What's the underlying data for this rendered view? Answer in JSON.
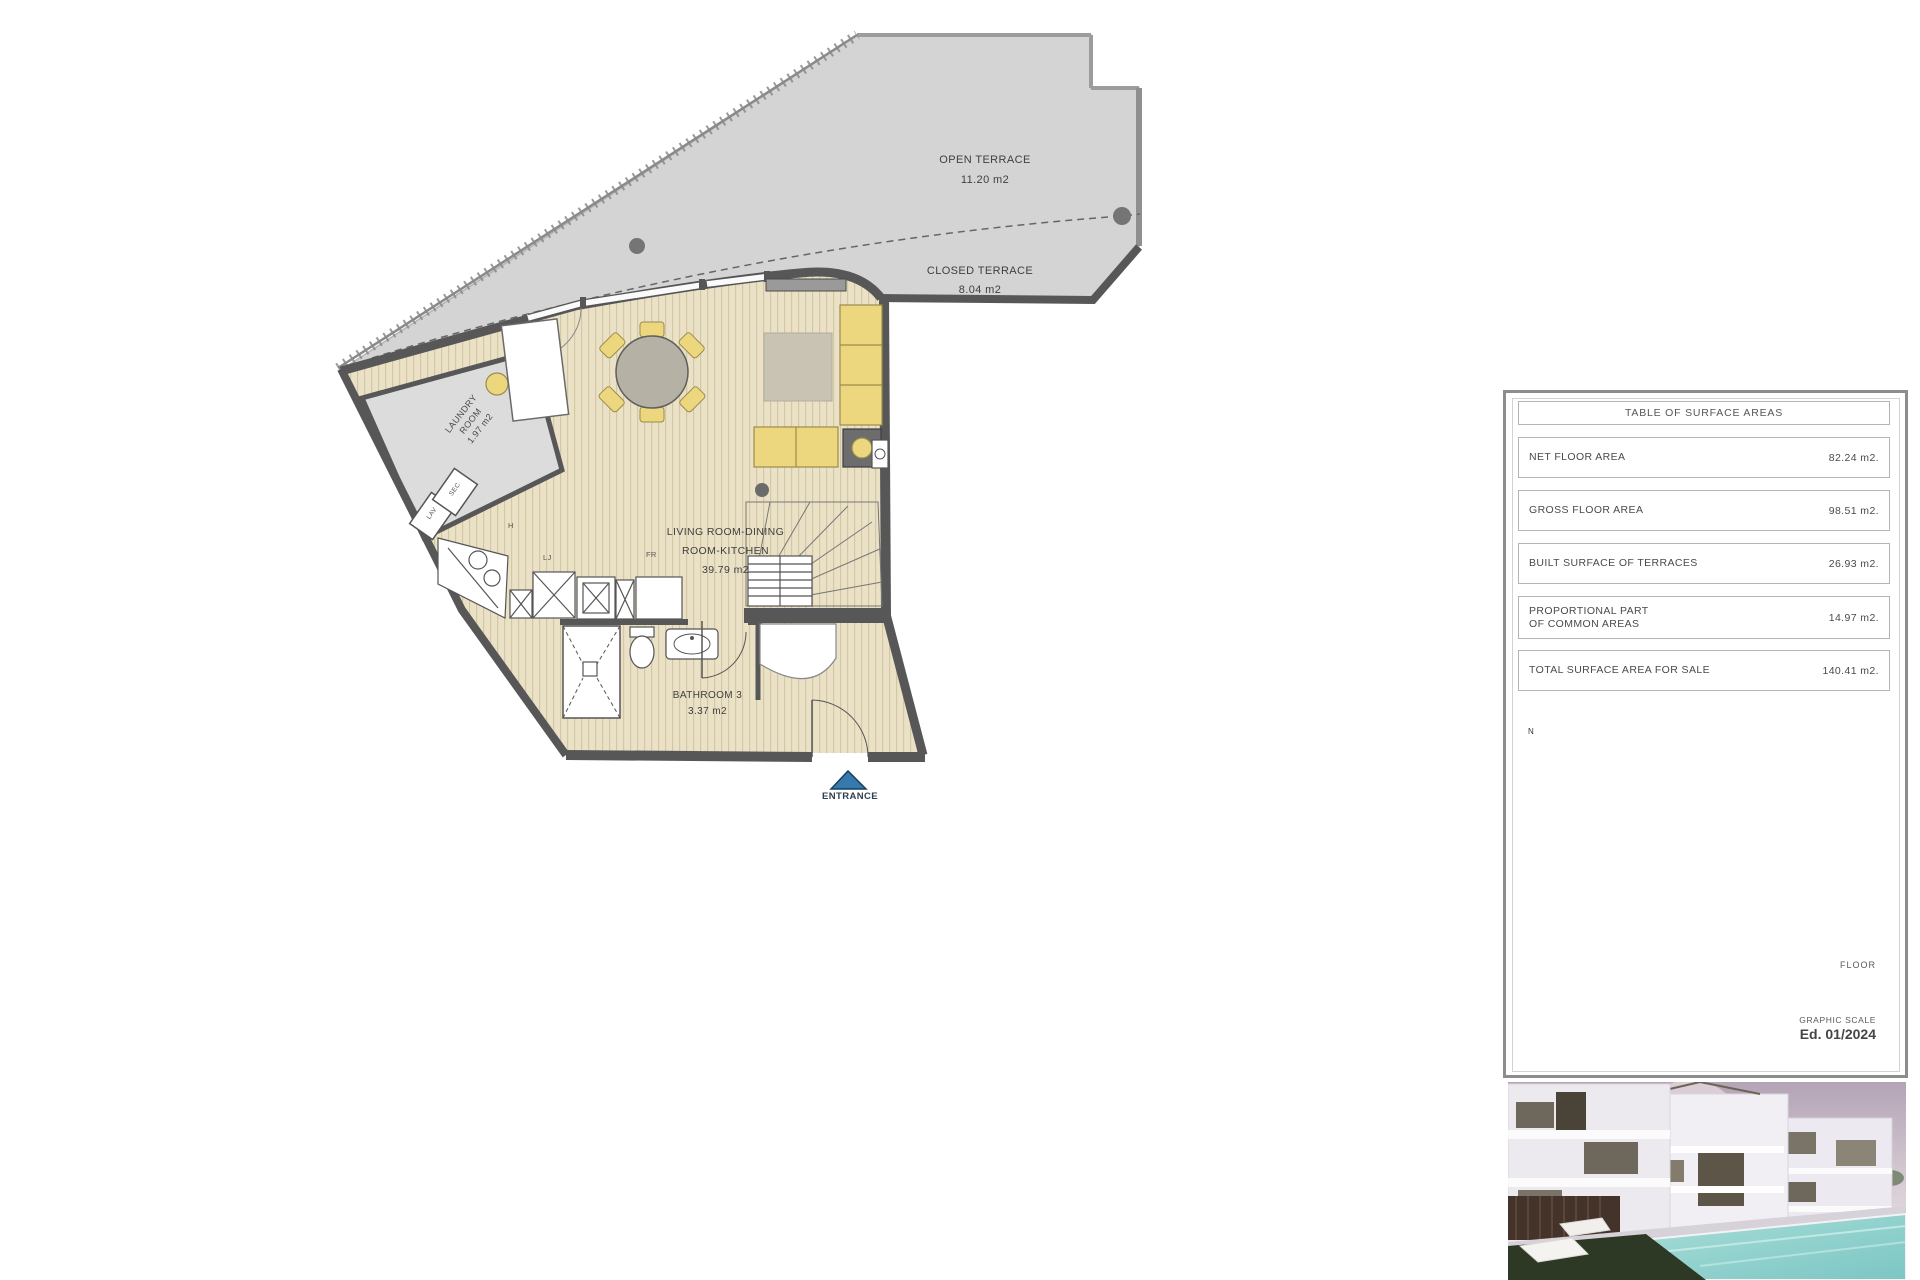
{
  "floor_plan": {
    "rooms": {
      "open_terrace": {
        "name": "OPEN TERRACE",
        "area": "11.20 m2"
      },
      "closed_terrace": {
        "name": "CLOSED TERRACE",
        "area": "8.04 m2"
      },
      "living": {
        "line1": "LIVING ROOM-DINING",
        "line2": "ROOM-KITCHEN",
        "area": "39.79 m2"
      },
      "bathroom": {
        "name": "BATHROOM 3",
        "area": "3.37 m2"
      },
      "laundry": {
        "line1": "LAUNDRY",
        "line2": "ROOM",
        "area": "1.97 m2"
      }
    },
    "labels": {
      "entrance": "ENTRANCE",
      "washer": "LAV",
      "dryer": "SEC",
      "hood": "H",
      "dishwasher": "LJ",
      "fridge": "FR",
      "north": "N"
    }
  },
  "surface_table": {
    "title": "TABLE OF SURFACE AREAS",
    "rows": [
      {
        "label": "NET FLOOR AREA",
        "label2": "",
        "value": "82.24 m2."
      },
      {
        "label": "GROSS FLOOR AREA",
        "label2": "",
        "value": "98.51 m2."
      },
      {
        "label": "BUILT SURFACE OF TERRACES",
        "label2": "",
        "value": "26.93 m2."
      },
      {
        "label": "PROPORTIONAL PART",
        "label2": "OF COMMON AREAS",
        "value": "14.97 m2."
      },
      {
        "label": "TOTAL SURFACE AREA FOR SALE",
        "label2": "",
        "value": "140.41 m2."
      }
    ]
  },
  "site": {
    "floor_label": "FLOOR",
    "graphic_scale_label": "GRAPHIC SCALE",
    "edition": "Ed. 01/2024",
    "scale_ticks": [
      "0",
      "1",
      "2",
      "3",
      "4"
    ]
  },
  "colors": {
    "highlight_red": "#d63058",
    "entrance_blue": "#3579ad",
    "terrace_gray": "#d4d4d4",
    "wall_gray": "#575757",
    "floor_tan": "#eae1c6",
    "furniture_yellow": "#ecd77e"
  }
}
